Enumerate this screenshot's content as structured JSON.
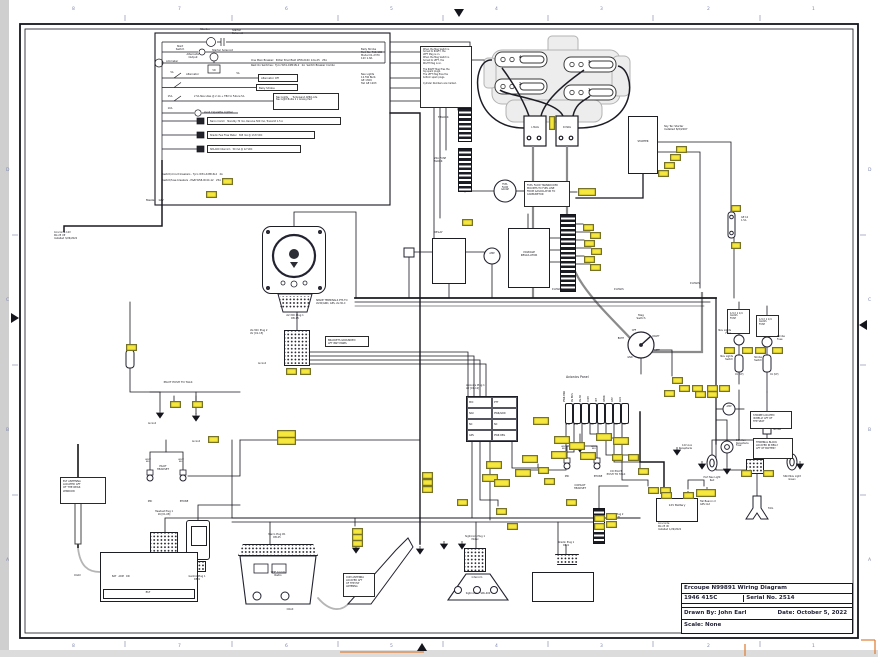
{
  "sheet": {
    "top_numbers": [
      "8",
      "7",
      "6",
      "5",
      "4",
      "3",
      "2",
      "1"
    ],
    "bottom_numbers": [
      "8",
      "7",
      "6",
      "5",
      "4",
      "3",
      "2",
      "1"
    ],
    "left_letters": [
      "D",
      "C",
      "B",
      "A"
    ],
    "right_letters": [
      "D",
      "C",
      "B",
      "A"
    ],
    "accent_tag_color": "#f6e83c",
    "orange_mark_color": "#e0823c"
  },
  "title_block": {
    "title": "Ercoupe N99891 Wiring Diagram",
    "model": "1946 415C",
    "serial": "Serial No. 2514",
    "drawn_by": "Drawn By:  John Earl",
    "date": "Date:  October 5, 2022",
    "scale": "Scale:  None"
  },
  "avionics_panel": {
    "title": "Avionics Panel",
    "breakers": [
      {
        "label": "PWR BKR",
        "amp": "15A"
      },
      {
        "label": "AV BUS",
        "amp": "10A"
      },
      {
        "label": "AV-30",
        "amp": "5A"
      },
      {
        "label": "COM",
        "amp": "5A"
      },
      {
        "label": "INT",
        "amp": "5A"
      },
      {
        "label": "XPDR",
        "amp": "3A"
      },
      {
        "label": "UAT",
        "amp": "2A"
      },
      {
        "label": "AUX",
        "amp": "2A"
      }
    ]
  },
  "plug_table": {
    "header": "Avionics Plug 1\nAV [01-12]",
    "rows": [
      [
        "MIC",
        "PTT"
      ],
      [
        "NAV",
        "PWR/GRD"
      ],
      [
        "NC",
        "NC"
      ],
      [
        "GPS",
        "PWR REG"
      ]
    ]
  },
  "engine": {
    "cylinders": [
      "4",
      "3",
      "2",
      "1"
    ],
    "left_mag": "L MAG",
    "right_mag": "R MAG",
    "starter": "STARTER"
  },
  "labels": [
    [
      205,
      28,
      "Starter",
      "c",
      2.8
    ],
    [
      232,
      29,
      "Starter\nSolenoid",
      "l",
      2.6
    ],
    [
      180,
      45,
      "Start\nSwitch",
      "c",
      2.6
    ],
    [
      212,
      49,
      "Starter Solenoid",
      "l",
      2.6
    ],
    [
      166,
      60,
      "Ammeter",
      "l",
      2.6
    ],
    [
      193,
      53,
      "Alternator\nOutput",
      "c",
      2.6
    ],
    [
      214,
      70,
      "VR",
      "c",
      2.4
    ],
    [
      251,
      60,
      "One Main Breaker:  Potter Brumfield W58-XC4C 12A-25   25A",
      "l",
      2.5
    ],
    [
      251,
      65,
      "Rest On Switches:  Tyco W31-X2M1N-2   2A  Switch Breaker Combo",
      "l",
      2.5
    ],
    [
      172,
      72,
      "5A",
      "c",
      2.4
    ],
    [
      186,
      73,
      "Alternator",
      "l",
      2.6
    ],
    [
      238,
      73,
      "5A",
      "c",
      2.4
    ],
    [
      170,
      96,
      "15A",
      "c",
      2.4
    ],
    [
      194,
      96,
      "2 5A Nav Lites @ 2.1A + TBX to Future 5A",
      "l",
      2.4
    ],
    [
      170,
      108,
      "10A",
      "c",
      2.4
    ],
    [
      204,
      111,
      "Avail Cigarette Lighter",
      "l",
      2.6
    ],
    [
      162,
      174,
      "Switch/circuit breakers - Tyco W31-X2M1N-2   2A",
      "l",
      2.5
    ],
    [
      162,
      180,
      "Switch/fuse breakers - P&B W58-XC4C-12   25A",
      "l",
      2.5
    ],
    [
      146,
      199,
      "Master   12V",
      "l",
      2.8
    ],
    [
      361,
      49,
      "Belly Strobe\nPart No. 716-100\nModel 01-2370\n12V 1.8A",
      "l",
      2.5
    ],
    [
      361,
      74,
      "Nav Lights\n12.5W Bulb\nGE 1309\nTail GE 1203",
      "l",
      2.5
    ],
    [
      519,
      55,
      "4",
      "l",
      3.8,
      1
    ],
    [
      588,
      60,
      "3",
      "l",
      3.8,
      1
    ],
    [
      519,
      82,
      "2",
      "l",
      3.8,
      1
    ],
    [
      588,
      88,
      "1",
      "l",
      3.8,
      1
    ],
    [
      535,
      127,
      "L MAG",
      "c",
      2.4
    ],
    [
      567,
      127,
      "R MAG",
      "c",
      2.4
    ],
    [
      643,
      141,
      "STARTER",
      "c",
      2.5
    ],
    [
      664,
      125,
      "Sky Tec Starter\nInstalled 8/2/2007",
      "l",
      2.6
    ],
    [
      741,
      217,
      "GE 12\n1.5A",
      "l",
      2.4
    ],
    [
      438,
      117,
      "T-BLOCK",
      "l",
      2.5
    ],
    [
      434,
      158,
      "20A FUSE\nBLOCK",
      "l",
      2.5
    ],
    [
      505,
      184,
      "FUEL\nFLOW\nGAUGE",
      "c",
      2.2
    ],
    [
      434,
      231,
      "RELAY",
      "l",
      2.8
    ],
    [
      529,
      251,
      "VOLTAGE\nREGULATOR",
      "c",
      2.7
    ],
    [
      492,
      253,
      "AMP",
      "c",
      2.4
    ],
    [
      552,
      289,
      "P-LEADS",
      "l",
      2.3
    ],
    [
      614,
      289,
      "P-LEADS",
      "l",
      2.3
    ],
    [
      690,
      283,
      "P-LEADS",
      "l",
      2.3
    ],
    [
      641,
      314,
      "Mag\nSwitch",
      "c",
      2.7
    ],
    [
      634,
      330,
      "OFF",
      "c",
      2.3
    ],
    [
      621,
      338,
      "BOTH",
      "c",
      2.3
    ],
    [
      656,
      336,
      "RIGHT",
      "c",
      2.3
    ],
    [
      657,
      350,
      "LEFT",
      "c",
      2.3
    ],
    [
      630,
      357,
      "GND",
      "c",
      2.3
    ],
    [
      566,
      376,
      "Avionics Panel",
      "l",
      3.2
    ],
    [
      466,
      385,
      "Avionics Plug 1\nAV [01-12]",
      "l",
      2.5
    ],
    [
      316,
      300,
      "SPADE TERMINALS PTS TO\nAV30/GRD, GPS, AV-30-C",
      "l",
      2.4
    ],
    [
      295,
      315,
      "AV-30C Plug 1\nDB-15",
      "c",
      2.5
    ],
    [
      250,
      330,
      "AV-30C Plug 2\nAV [01-15]",
      "l",
      2.5
    ],
    [
      178,
      381,
      "PILOT PUSH TO TALK",
      "c",
      2.8
    ],
    [
      148,
      423,
      "Av Gnd",
      "l",
      2.3
    ],
    [
      192,
      441,
      "Av Gnd",
      "l",
      2.3
    ],
    [
      258,
      363,
      "Av Gnd",
      "l",
      2.3
    ],
    [
      163,
      465,
      "PILOT\nHEADSET",
      "c",
      2.6
    ],
    [
      150,
      501,
      "MIC",
      "c",
      2.4
    ],
    [
      184,
      501,
      "PHONE",
      "c",
      2.4
    ],
    [
      148,
      459,
      "WHT/\nBLU",
      "c",
      2.1
    ],
    [
      181,
      459,
      "WHT/\nBLU",
      "c",
      2.1
    ],
    [
      164,
      511,
      "Headset Plug 1\n16 [01-08]",
      "c",
      2.4
    ],
    [
      74,
      575,
      "COAX",
      "l",
      2.4
    ],
    [
      290,
      609,
      "COAX",
      "c",
      2.4
    ],
    [
      197,
      576,
      "Garmin Plug 1\nDB-9",
      "c",
      2.4
    ],
    [
      277,
      534,
      "Narco Plug #1\nDB-25",
      "c",
      2.4
    ],
    [
      278,
      571,
      "VHF Comm\nRadio",
      "c",
      2.6
    ],
    [
      475,
      536,
      "Sigtronics Plug 1\nMolex",
      "c",
      2.4
    ],
    [
      477,
      577,
      "Intercom",
      "c",
      2.4
    ],
    [
      478,
      593,
      "Sigtronics    SPA-400",
      "c",
      2.4
    ],
    [
      566,
      542,
      "Shadin Plug 1\nDB-9",
      "c",
      2.4
    ],
    [
      607,
      514,
      "Shadin Plug 2\n16 [DC-15]",
      "l",
      2.4
    ],
    [
      616,
      470,
      "CO PILOT\nPUSH TO TALK",
      "c",
      2.6
    ],
    [
      580,
      484,
      "COPILOT\nHEADSET",
      "c",
      2.6
    ],
    [
      567,
      476,
      "MIC",
      "c",
      2.4
    ],
    [
      598,
      476,
      "PHONE",
      "c",
      2.4
    ],
    [
      564,
      446,
      "WHT/\nBLU",
      "c",
      2.1
    ],
    [
      594,
      446,
      "WHT/\nBLU",
      "c",
      2.1
    ],
    [
      677,
      504,
      "12V Battery",
      "c",
      2.8
    ],
    [
      658,
      523,
      "Concorde\nRG 25 XC\nInstalled 1/29/2022",
      "l",
      2.4
    ],
    [
      700,
      501,
      "Tail Beacon X\nGPS Out",
      "l",
      2.4
    ],
    [
      768,
      507,
      "TAIL",
      "l",
      2.6
    ],
    [
      692,
      445,
      "12V Aux\nReceptacle",
      "r",
      2.4
    ],
    [
      736,
      440,
      "15A Aux\nReceptacle\nFuse",
      "l",
      2.3
    ],
    [
      712,
      477,
      "Port Nav Light\nRed",
      "c",
      2.4
    ],
    [
      792,
      476,
      "Stbd Nav Light\nGreen",
      "c",
      2.4
    ],
    [
      731,
      330,
      "Nav Lights\nFuse",
      "r",
      2.4
    ],
    [
      777,
      336,
      "Strobe\nFuse",
      "l",
      2.4
    ],
    [
      733,
      356,
      "Nav Lights\nSwitch",
      "r",
      2.4
    ],
    [
      762,
      357,
      "Strobe\nSwitch",
      "r",
      2.4
    ],
    [
      735,
      374,
      "On (UP)",
      "l",
      2.2
    ],
    [
      770,
      374,
      "On (UP)",
      "l",
      2.2
    ],
    [
      729,
      406,
      "AMP",
      "c",
      2.3
    ],
    [
      773,
      429,
      "Strobe",
      "l",
      2.4
    ],
    [
      54,
      232,
      "Concorde 12V\nRG 25 XP\nInstalled 3/26/2022",
      "l",
      2.4
    ],
    [
      112,
      576,
      "BAT   ARM   ON",
      "l",
      2.3
    ],
    [
      148,
      591,
      "ELT",
      "c",
      2.8
    ]
  ],
  "notes": [
    [
      420,
      46,
      52,
      62,
      "When the Mag Switch is\nturned to RIGHT, the\nLEFT Mag is on.\nWhen the Mag Switch is\nturned to LEFT, the\nRIGHT Mag is on.\n\nThe RIGHT Mag fires the\ntop spark plugs.\nThe LEFT Mag fires the\nbottom spark plugs.\n\nCylinder Numbers are marked.",
      2.2
    ],
    [
      524,
      181,
      46,
      26,
      "FUEL FLOW TRANSDUCER\nMOUNTS TO FUEL LINE\nFROM GASCOLATOR TO\nCARBURETOR",
      2.4
    ],
    [
      727,
      309,
      23,
      25,
      "1/4 X 1 1/4\nGLASS\nFUSE",
      2.3
    ],
    [
      756,
      315,
      23,
      22,
      "1/4 X 1 1/4\nGLASS\nFUSE",
      2.3
    ],
    [
      753,
      438,
      40,
      21,
      "TERMINAL BLOCK\nLOCATED IN BELLY\nAFT OF BATTERY",
      2.4
    ],
    [
      750,
      411,
      42,
      18,
      "STROBE LOCATED\nIN BELLY AFT OF\nTHE SEAT",
      2.4
    ],
    [
      60,
      477,
      46,
      27,
      "ELT ANTENNA\nLOCATED AFT\nOF THE REAR\nWINDOW",
      2.6
    ],
    [
      343,
      573,
      32,
      24,
      "COM ANTENNA\nLOCATED AFT\nOF THE ELT\nANTENNA",
      2.4
    ],
    [
      325,
      336,
      44,
      11,
      "BRACKETS GROUNDED\nAFT INST PANEL",
      2.4
    ],
    [
      258,
      74,
      40,
      8,
      "Alternator Off",
      2.6
    ],
    [
      256,
      84,
      42,
      7,
      "Belly Strobe",
      2.6
    ],
    [
      273,
      93,
      66,
      17,
      "Nav Lights      Turbowand AERO-Lite\nNav Light Bulbs 2 x Airway Part",
      2.3
    ],
    [
      207,
      117,
      134,
      8,
      "Narco Comm   Standby 70 mA, Receive 500 mA, Transmit 1.5 A",
      2.3
    ],
    [
      207,
      131,
      108,
      8,
      "Shadin Fuel Flow Meter   365 mA @ 13.8 VDC",
      2.3
    ],
    [
      207,
      145,
      94,
      8,
      "SPA-400 Intercom   50 mA @ 12 VDC",
      2.3
    ]
  ],
  "wire_tags": [
    [
      549,
      116,
      4,
      12
    ],
    [
      676,
      146
    ],
    [
      670,
      154
    ],
    [
      664,
      162
    ],
    [
      658,
      170
    ],
    [
      731,
      205,
      8,
      5
    ],
    [
      731,
      242,
      8,
      5
    ],
    [
      578,
      188,
      16,
      6
    ],
    [
      462,
      219
    ],
    [
      583,
      224
    ],
    [
      590,
      232
    ],
    [
      584,
      240
    ],
    [
      591,
      248
    ],
    [
      584,
      256
    ],
    [
      590,
      264
    ],
    [
      533,
      417,
      14,
      6
    ],
    [
      554,
      436,
      14,
      6
    ],
    [
      569,
      442,
      14,
      6
    ],
    [
      596,
      433,
      14,
      6
    ],
    [
      613,
      437,
      14,
      6
    ],
    [
      522,
      455,
      14,
      6
    ],
    [
      551,
      451,
      14,
      6
    ],
    [
      580,
      452,
      14,
      6
    ],
    [
      486,
      461,
      14,
      6
    ],
    [
      515,
      469,
      14,
      6
    ],
    [
      482,
      474,
      14,
      6
    ],
    [
      494,
      479,
      14,
      6
    ],
    [
      612,
      454
    ],
    [
      628,
      454
    ],
    [
      222,
      178
    ],
    [
      206,
      191
    ],
    [
      286,
      368
    ],
    [
      300,
      368
    ],
    [
      277,
      430,
      17,
      6
    ],
    [
      277,
      437,
      17,
      6
    ],
    [
      170,
      401
    ],
    [
      192,
      401
    ],
    [
      126,
      344
    ],
    [
      208,
      436
    ],
    [
      352,
      528
    ],
    [
      352,
      534
    ],
    [
      352,
      540
    ],
    [
      422,
      472
    ],
    [
      422,
      479
    ],
    [
      422,
      486
    ],
    [
      457,
      499
    ],
    [
      496,
      508
    ],
    [
      507,
      523
    ],
    [
      538,
      467
    ],
    [
      544,
      478
    ],
    [
      566,
      499
    ],
    [
      606,
      513
    ],
    [
      606,
      521
    ],
    [
      638,
      468
    ],
    [
      648,
      487
    ],
    [
      660,
      487
    ],
    [
      672,
      377
    ],
    [
      679,
      385
    ],
    [
      664,
      390
    ],
    [
      695,
      391
    ],
    [
      707,
      391
    ],
    [
      724,
      347
    ],
    [
      742,
      347
    ],
    [
      755,
      347
    ],
    [
      772,
      347
    ],
    [
      692,
      385
    ],
    [
      707,
      385
    ],
    [
      719,
      385
    ],
    [
      741,
      470
    ],
    [
      763,
      470
    ],
    [
      696,
      489,
      18,
      6
    ],
    [
      661,
      492
    ],
    [
      683,
      492
    ],
    [
      594,
      515
    ],
    [
      594,
      523
    ]
  ],
  "grounds": [
    [
      420,
      549
    ],
    [
      160,
      413
    ],
    [
      196,
      416
    ],
    [
      727,
      469
    ],
    [
      702,
      464
    ],
    [
      800,
      464
    ],
    [
      767,
      441
    ],
    [
      707,
      490
    ],
    [
      356,
      548
    ],
    [
      444,
      544
    ],
    [
      462,
      544
    ],
    [
      677,
      450
    ],
    [
      580,
      447
    ]
  ]
}
